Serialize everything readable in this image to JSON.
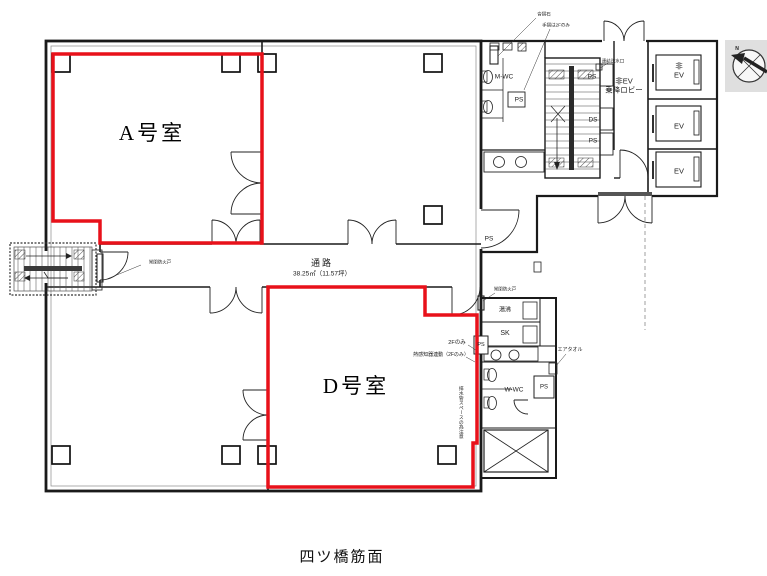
{
  "caption": "四ツ橋筋面",
  "rooms": {
    "a": "A号室",
    "d": "D号室"
  },
  "corridor": {
    "name": "通路",
    "area": "38.25㎡（11.57坪）"
  },
  "labels": {
    "m_wc": "M-WC",
    "w_wc": "W-WC",
    "ps": "PS",
    "ds": "DS",
    "sk": "SK",
    "yuwakashi": "湯沸",
    "air_towel": "エアタオル",
    "ev": "EV",
    "hijo_ev_car": "非\nEV",
    "ev_lobby": "非EV\n乗降ロビー",
    "renketsu": "連結送水口",
    "kutsuzuri": "沓摺石",
    "tesuri": "手摺は2Fのみ",
    "fire_door": "常閉防火戸",
    "nif_only": "2Fのみ",
    "netsu": "熱感知器連動（2Fのみ）",
    "vertical_note": "排水管スペースの為注意",
    "compass_n": "N"
  },
  "colors": {
    "unit_outline": "#e8111a",
    "wall": "#1a1a1a"
  }
}
